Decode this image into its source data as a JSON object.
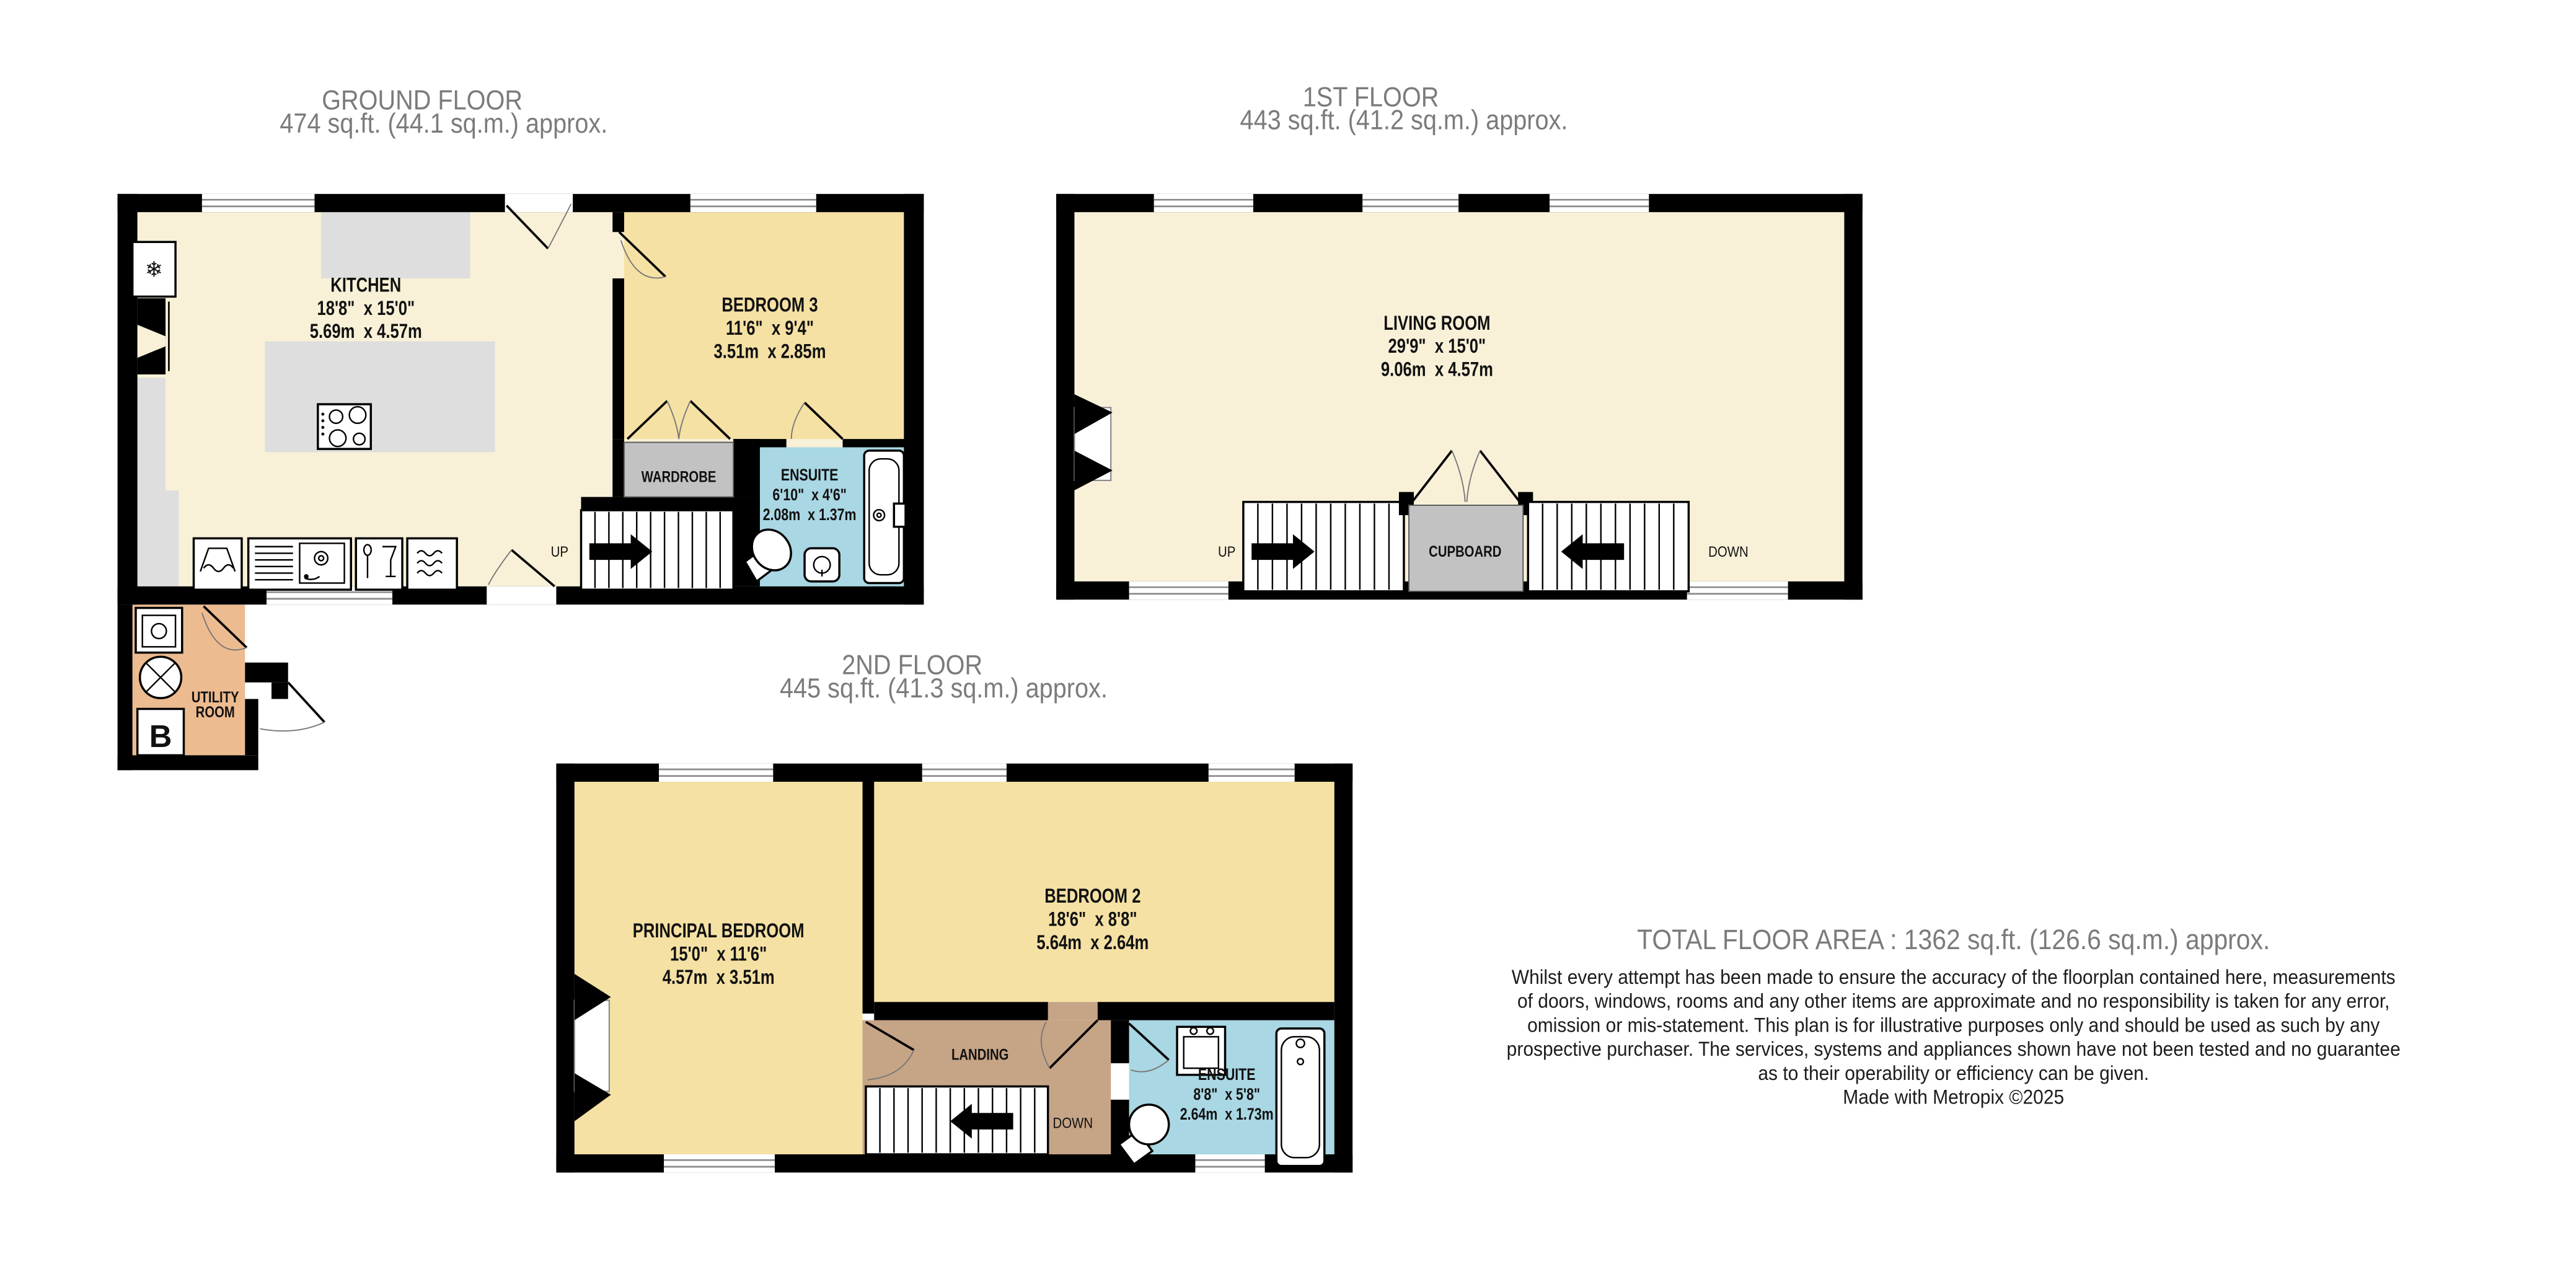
{
  "floors": {
    "ground": {
      "title": "GROUND FLOOR",
      "area": "474 sq.ft. (44.1 sq.m.) approx.",
      "rooms": {
        "kitchen": {
          "name": "KITCHEN",
          "imperial": "18'8\"  x 15'0\"",
          "metric": "5.69m  x 4.57m"
        },
        "bedroom3": {
          "name": "BEDROOM 3",
          "imperial": "11'6\"  x 9'4\"",
          "metric": "3.51m  x 2.85m"
        },
        "ensuite": {
          "name": "ENSUITE",
          "imperial": "6'10\"  x 4'6\"",
          "metric": "2.08m  x 1.37m"
        },
        "wardrobe": {
          "name": "WARDROBE"
        },
        "utility": {
          "name_line1": "UTILITY",
          "name_line2": "ROOM"
        }
      },
      "labels": {
        "up": "UP"
      },
      "icons": {
        "boiler_letter": "B",
        "fridge_glyph": "❄"
      }
    },
    "first": {
      "title": "1ST FLOOR",
      "area": "443 sq.ft. (41.2 sq.m.) approx.",
      "rooms": {
        "living_room": {
          "name": "LIVING ROOM",
          "imperial": "29'9\"  x 15'0\"",
          "metric": "9.06m  x 4.57m"
        },
        "cupboard": {
          "name": "CUPBOARD"
        }
      },
      "labels": {
        "up": "UP",
        "down": "DOWN"
      }
    },
    "second": {
      "title": "2ND FLOOR",
      "area": "445 sq.ft. (41.3 sq.m.) approx.",
      "rooms": {
        "principal_bedroom": {
          "name": "PRINCIPAL BEDROOM",
          "imperial": "15'0\"  x 11'6\"",
          "metric": "4.57m  x 3.51m"
        },
        "bedroom2": {
          "name": "BEDROOM 2",
          "imperial": "18'6\"  x 8'8\"",
          "metric": "5.64m  x 2.64m"
        },
        "ensuite": {
          "name": "ENSUITE",
          "imperial": "8'8\"  x 5'8\"",
          "metric": "2.64m  x 1.73m"
        },
        "landing": {
          "name": "LANDING"
        }
      },
      "labels": {
        "down": "DOWN"
      }
    }
  },
  "summary": {
    "total_area": "TOTAL FLOOR AREA : 1362 sq.ft. (126.6 sq.m.) approx.",
    "disclaimer_lines": [
      "Whilst every attempt has been made to ensure the accuracy of the floorplan contained here, measurements",
      "of doors, windows, rooms and any other items are approximate and no responsibility is taken for any error,",
      "omission or mis-statement. This plan is for illustrative purposes only and should be used as such by any",
      "prospective purchaser. The services, systems and appliances shown have not been tested and no guarantee",
      "as to their operability or efficiency can be given."
    ],
    "credit": "Made with Metropix ©2025"
  },
  "colors": {
    "wall": "#000000",
    "room_cream": "#F8F1D8",
    "room_tan": "#F5E1A4",
    "landing_tan": "#C6A486",
    "utility_tan": "#EDBB90",
    "ensuite_blue": "#A9D7E3",
    "storage_gray": "#C2C2C2",
    "counter_gray": "#DEDEDE",
    "title_gray": "#7B7B7B"
  }
}
